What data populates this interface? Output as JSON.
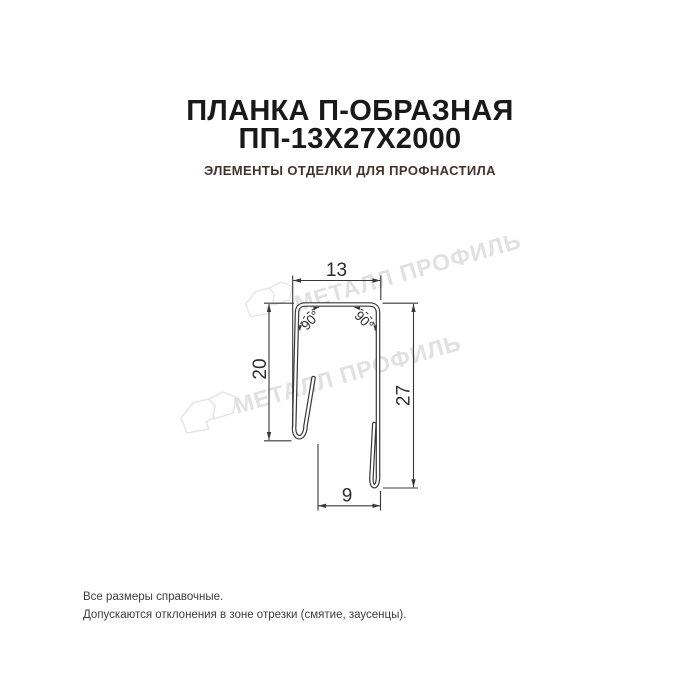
{
  "header": {
    "title_line1": "ПЛАНКА П-ОБРАЗНАЯ",
    "title_line2": "ПП-13Х27Х2000",
    "subtitle": "ЭЛЕМЕНТЫ ОТДЕЛКИ ДЛЯ ПРОФНАСТИЛА",
    "title_color": "#191919",
    "subtitle_color": "#45322e"
  },
  "drawing": {
    "type": "technical-cross-section",
    "product": "Планка П-образная ПП-13х27х2000",
    "line_color": "#383838",
    "dims": {
      "top": "13",
      "left": "20",
      "right": "27",
      "bottom": "9",
      "angle_left": "90°",
      "angle_right": "90°"
    },
    "watermark": {
      "text": "МЕТАЛЛ ПРОФИЛЬ",
      "color": "#e1e1e1",
      "logo": "metall-profil-logo"
    }
  },
  "footer": {
    "line1": "Все размеры справочные.",
    "line2": "Допускаются отклонения в зоне отрезки (смятие, заусенцы)."
  }
}
